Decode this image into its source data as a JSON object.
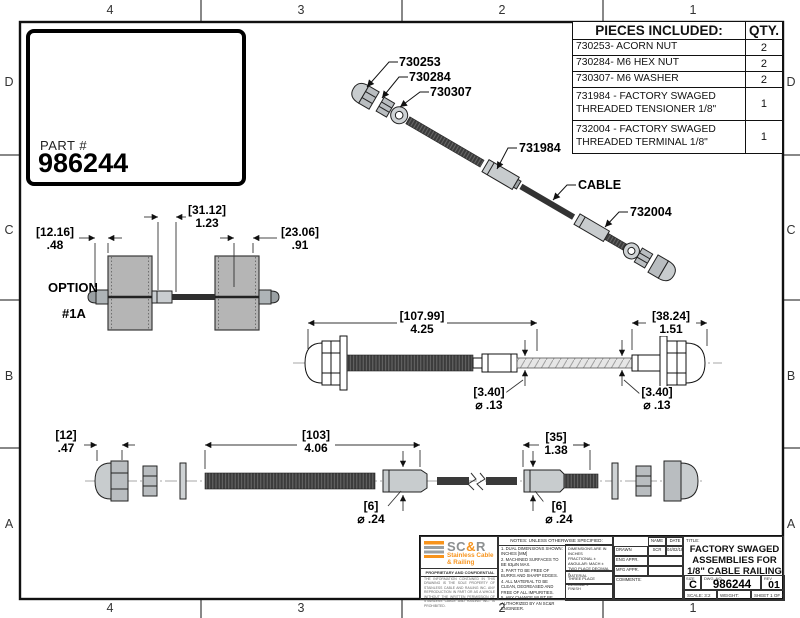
{
  "colors": {
    "accent_orange": "#f7941d",
    "metal_gray": "#c8ccce",
    "cable_dark": "#3a3a3a",
    "post_gray": "#b5b5b5"
  },
  "sheet": {
    "zones_top": [
      "4",
      "3",
      "2",
      "1"
    ],
    "zones_bottom": [
      "4",
      "3",
      "2",
      "1"
    ],
    "zones_left": [
      "D",
      "C",
      "B",
      "A"
    ],
    "zones_right": [
      "D",
      "C",
      "B",
      "A"
    ]
  },
  "part_box": {
    "label": "PART #",
    "number": "986244"
  },
  "pieces_table": {
    "header": {
      "desc": "PIECES INCLUDED:",
      "qty": "QTY."
    },
    "rows": [
      {
        "desc": "730253- ACORN NUT",
        "qty": "2"
      },
      {
        "desc": "730284- M6 HEX NUT",
        "qty": "2"
      },
      {
        "desc": "730307- M6 WASHER",
        "qty": "2"
      },
      {
        "desc": "731984 - FACTORY SWAGED THREADED TENSIONER 1/8\"",
        "qty": "1"
      },
      {
        "desc": "732004 - FACTORY SWAGED THREADED TERMINAL 1/8\"",
        "qty": "1"
      }
    ]
  },
  "callouts": {
    "acorn_nut": "730253",
    "hex_nut": "730284",
    "washer": "730307",
    "tensioner": "731984",
    "cable": "CABLE",
    "terminal": "732004"
  },
  "option_view": {
    "line1": "OPTION",
    "line2": "#1A"
  },
  "dims": {
    "opt_left": {
      "mm": "[12.16]",
      "in": ".48"
    },
    "opt_mid": {
      "mm": "[31.12]",
      "in": "1.23"
    },
    "opt_right": {
      "mm": "[23.06]",
      "in": ".91"
    },
    "mid_len": {
      "mm": "[107.99]",
      "in": "4.25"
    },
    "mid_right": {
      "mm": "[38.24]",
      "in": "1.51"
    },
    "mid_dia1": {
      "mm": "[3.40]",
      "in": "⌀ .13"
    },
    "mid_dia2": {
      "mm": "[3.40]",
      "in": "⌀ .13"
    },
    "bot_left": {
      "mm": "[12]",
      "in": ".47"
    },
    "bot_len": {
      "mm": "[103]",
      "in": "4.06"
    },
    "bot_right": {
      "mm": "[35]",
      "in": "1.38"
    },
    "bot_dia1": {
      "mm": "[6]",
      "in": "⌀ .24"
    },
    "bot_dia2": {
      "mm": "[6]",
      "in": "⌀ .24"
    }
  },
  "title_block": {
    "logo": {
      "name_sc": "SC",
      "name_amp": "&",
      "name_r": "R",
      "sub1": "Stainless Cable",
      "sub2": "& Railing",
      "confidential": "PROPRIETARY AND CONFIDENTIAL",
      "fine_print": "THE INFORMATION CONTAINED IN THIS DRAWING IS THE SOLE PROPERTY OF STAINLESS CABLE AND RAILING INC. ANY REPRODUCTION IN PART OR AS A WHOLE WITHOUT THE WRITTEN PERMISSION OF STAINLESS CABLE AND RAILING INC. IS PROHIBITED."
    },
    "notes_header": "NOTES: UNLESS OTHERWISE SPECIFIED:",
    "notes": [
      "1. DUAL DIMENSIONS SHOWN: INCHES [MM]",
      "2. MACHINED SURFACES TO BE 63µIN MAX.",
      "3. PART TO BE FREE OF BURRS AND SHARP EDGES.",
      "4. ALL MATERIAL TO BE CLEAN, DEGREASED AND FREE OF ALL IMPURITIES.",
      "5. ANY CHANGE MUST BE AUTHORIZED BY AN SC&R ENGINEER."
    ],
    "tolerances": [
      "DIMENSIONS ARE IN INCHES",
      "FRACTIONAL ±",
      "ANGULAR: MACH ±",
      "TWO PLACE DECIMAL ±",
      "THREE PLACE DECIMAL ±"
    ],
    "material_label": "MATERIAL",
    "finish_label": "FINISH",
    "approvals": {
      "name_header": "NAME",
      "date_header": "DATE",
      "drawn_label": "DRAWN",
      "drawn_name": "SCR",
      "drawn_date": "04/02/18",
      "eng_label": "ENG APPR.",
      "mfg_label": "MFG APPR.",
      "comments_label": "COMMENTS:"
    },
    "title_label": "TITLE:",
    "title_line1": "FACTORY SWAGED",
    "title_line2": "ASSEMBLIES FOR",
    "title_line3": "1/8\" CABLE RAILING",
    "size_label": "SIZE",
    "size": "C",
    "dwg_label": "DWG. NO.",
    "dwg_no": "986244",
    "rev_label": "REV",
    "rev": "01",
    "scale": "SCALE: 3:2",
    "weight": "WEIGHT:",
    "sheet": "SHEET 1 OF 1"
  }
}
